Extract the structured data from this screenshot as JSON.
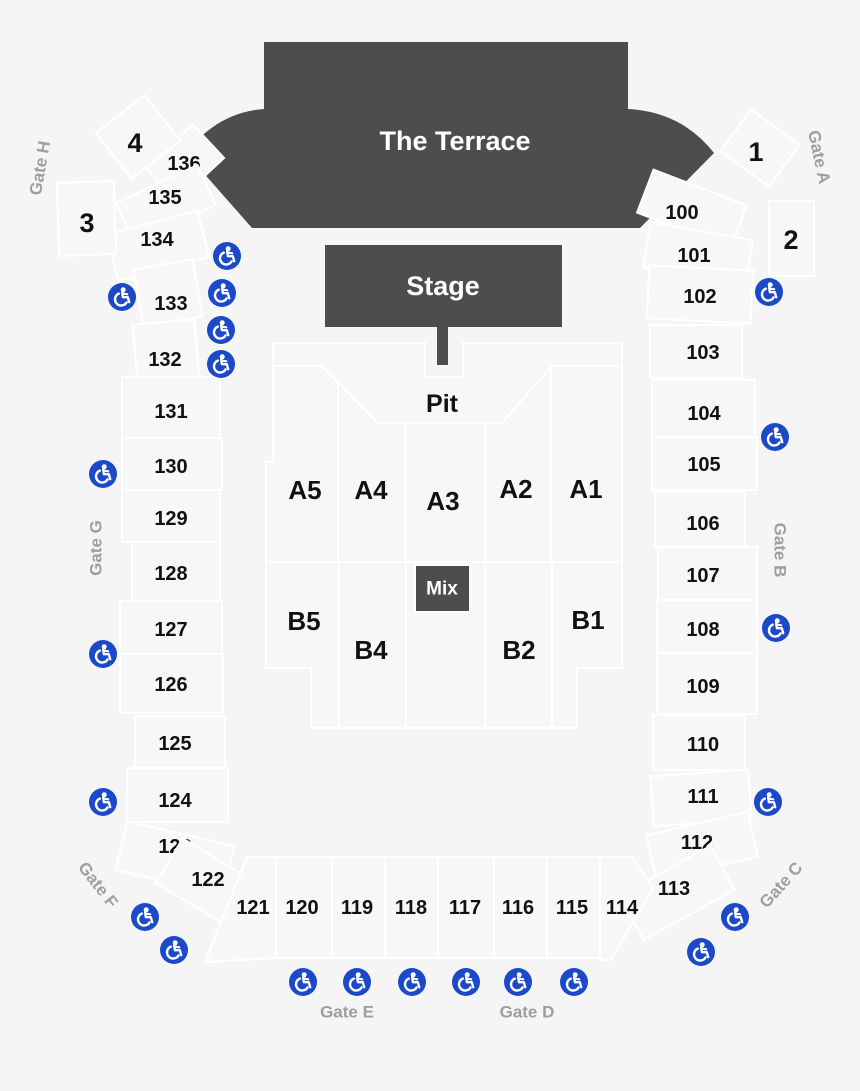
{
  "colors": {
    "background": "#f5f5f5",
    "dark_section": "#4d4d4d",
    "section_fill": "#f7f7f7",
    "section_stroke": "#ffffff",
    "accessible_blue": "#1b49c8",
    "gate_label": "#9e9e9e",
    "number_label": "#111111",
    "light_label": "#ffffff"
  },
  "areas": {
    "terrace": "The Terrace",
    "stage": "Stage",
    "pit": "Pit",
    "mix": "Mix"
  },
  "corners": {
    "box1": "1",
    "box2": "2",
    "box3": "3",
    "box4": "4"
  },
  "gates": {
    "gate_a": "Gate A",
    "gate_b": "Gate B",
    "gate_c": "Gate C",
    "gate_d": "Gate D",
    "gate_e": "Gate E",
    "gate_f": "Gate F",
    "gate_g": "Gate G",
    "gate_h": "Gate H"
  },
  "floor": {
    "a1": "A1",
    "a2": "A2",
    "a3": "A3",
    "a4": "A4",
    "a5": "A5",
    "b1": "B1",
    "b2": "B2",
    "b4": "B4",
    "b5": "B5"
  },
  "sections": {
    "s100": "100",
    "s101": "101",
    "s102": "102",
    "s103": "103",
    "s104": "104",
    "s105": "105",
    "s106": "106",
    "s107": "107",
    "s108": "108",
    "s109": "109",
    "s110": "110",
    "s111": "111",
    "s112": "112",
    "s113": "113",
    "s114": "114",
    "s115": "115",
    "s116": "116",
    "s117": "117",
    "s118": "118",
    "s119": "119",
    "s120": "120",
    "s121": "121",
    "s122": "122",
    "s123": "123",
    "s124": "124",
    "s125": "125",
    "s126": "126",
    "s127": "127",
    "s128": "128",
    "s129": "129",
    "s130": "130",
    "s131": "131",
    "s132": "132",
    "s133": "133",
    "s134": "134",
    "s135": "135",
    "s136": "136"
  },
  "icons": {
    "wheelchair_glyph": "♿",
    "wheelchair_meaning": "wheelchair-accessible seating"
  }
}
